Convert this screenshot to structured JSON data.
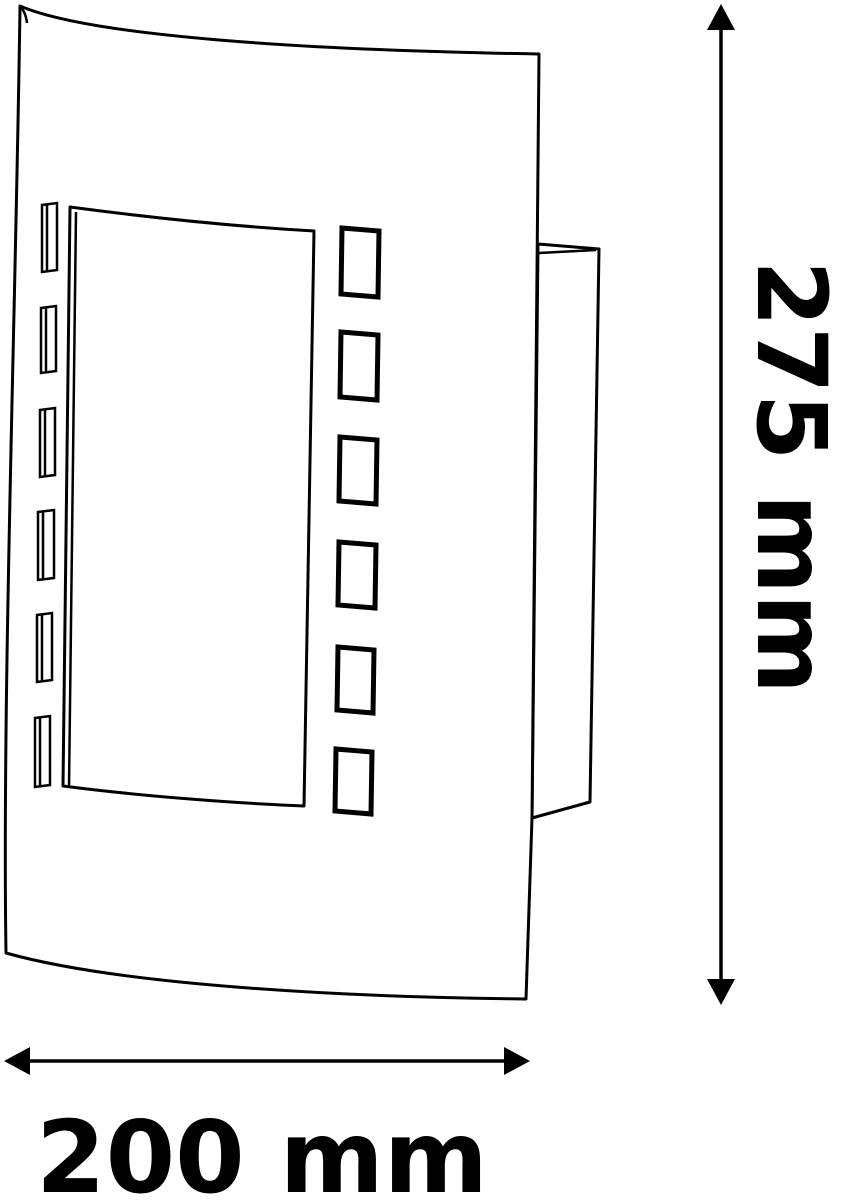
{
  "page": {
    "background_color": "#ffffff",
    "line_color": "#000000"
  },
  "diagram": {
    "type": "technical-dimension-drawing",
    "subject": "curved-front wall lamp, three-quarter line drawing",
    "lamp": {
      "left_slot_count": 6,
      "right_slot_count": 6,
      "has_rectangular_window_cutout": true,
      "has_back_wall_housing": true
    },
    "dimensions": {
      "height": {
        "label": "275 mm",
        "value": 275,
        "unit": "mm",
        "orientation": "vertical"
      },
      "width": {
        "label": "200 mm",
        "value": 200,
        "unit": "mm",
        "orientation": "horizontal"
      }
    }
  }
}
